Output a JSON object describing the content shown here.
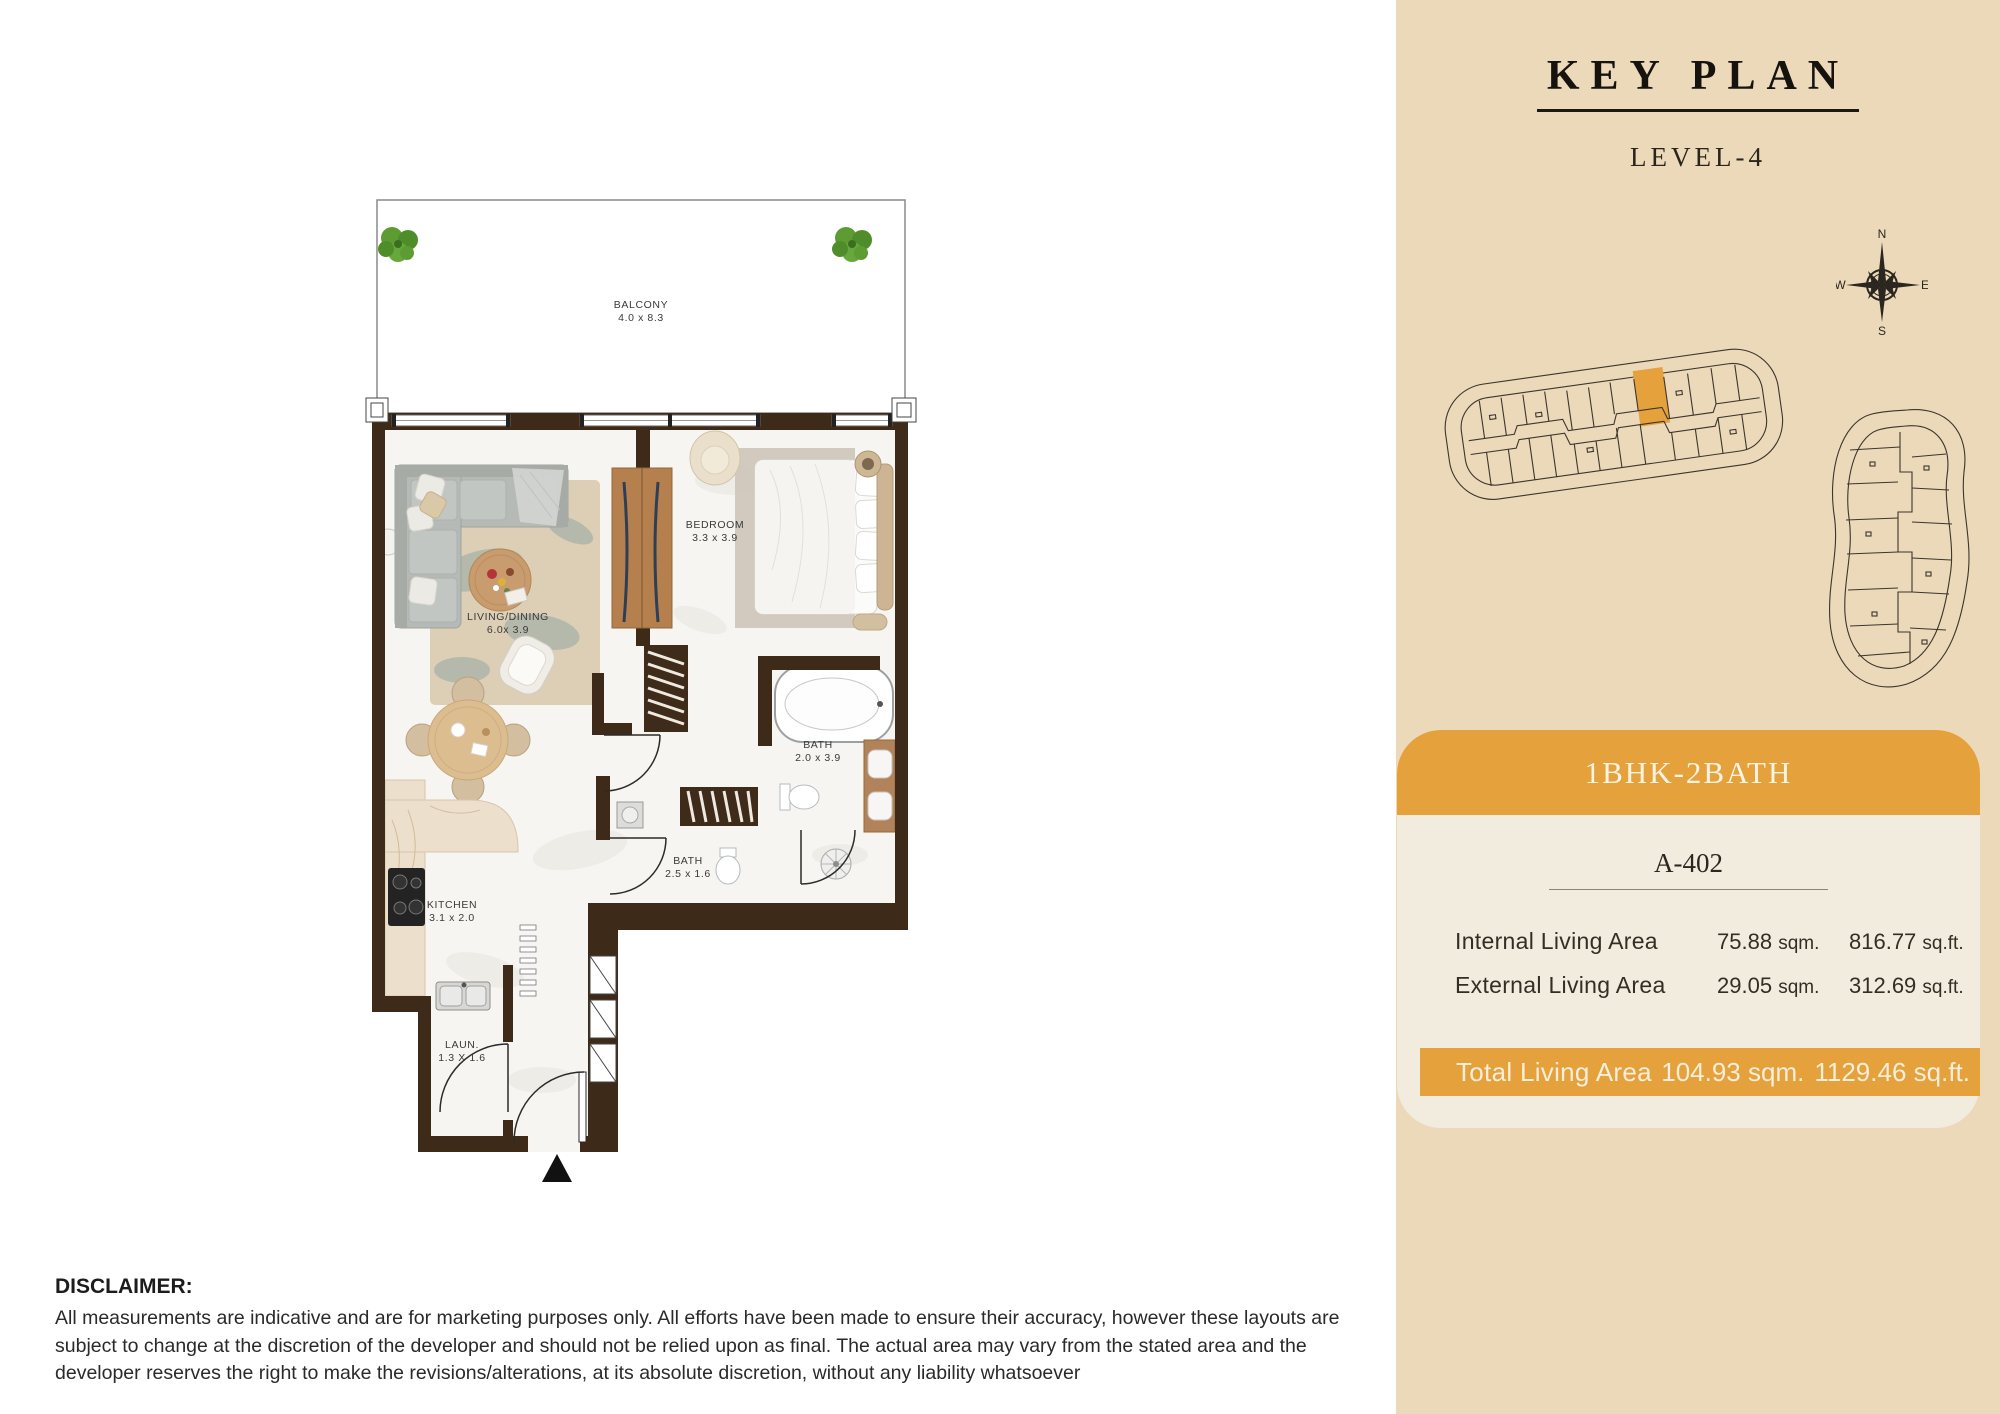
{
  "colors": {
    "accent": "#e4a13c",
    "wall": "#3e2a19",
    "sidebar_bg": "#ebd9ba",
    "card_bg": "#f2ecdf",
    "page_bg": "#ffffff"
  },
  "key_plan": {
    "title": "KEY PLAN",
    "level": "LEVEL-4",
    "compass": {
      "north": "N",
      "east": "E",
      "south": "S",
      "west": "W"
    }
  },
  "floor_plan": {
    "rooms": [
      {
        "name": "BALCONY",
        "dims": "4.0 x 8.3"
      },
      {
        "name": "BEDROOM",
        "dims": "3.3 x 3.9"
      },
      {
        "name": "LIVING/DINING",
        "dims": "6.0x 3.9"
      },
      {
        "name": "BATH",
        "dims": "2.0 x 3.9"
      },
      {
        "name": "BATH",
        "dims": "2.5 x 1.6"
      },
      {
        "name": "KITCHEN",
        "dims": "3.1 x 2.0"
      },
      {
        "name": "LAUN.",
        "dims": "1.3 X 1.6"
      }
    ]
  },
  "unit_card": {
    "type_label": "1BHK-2BATH",
    "unit_number": "A-402",
    "rows": [
      {
        "label": "Internal Living Area",
        "sqm_value": "75.88",
        "sqm_unit": "sqm.",
        "sqft_value": "816.77",
        "sqft_unit": "sq.ft."
      },
      {
        "label": "External Living Area",
        "sqm_value": "29.05",
        "sqm_unit": "sqm.",
        "sqft_value": "312.69",
        "sqft_unit": "sq.ft."
      }
    ],
    "total": {
      "label": "Total Living Area",
      "sqm_value": "104.93",
      "sqm_unit": "sqm.",
      "sqft_value": "1129.46",
      "sqft_unit": "sq.ft."
    }
  },
  "disclaimer": {
    "title": "DISCLAIMER:",
    "body": "All measurements are indicative and are for marketing purposes only. All efforts have been made to ensure their accuracy, however these layouts are subject to change at the discretion of the developer and should not be relied upon as final. The actual area may vary from the stated area and the developer reserves the right to make the revisions/alterations, at its absolute discretion, without any liability whatsoever"
  }
}
